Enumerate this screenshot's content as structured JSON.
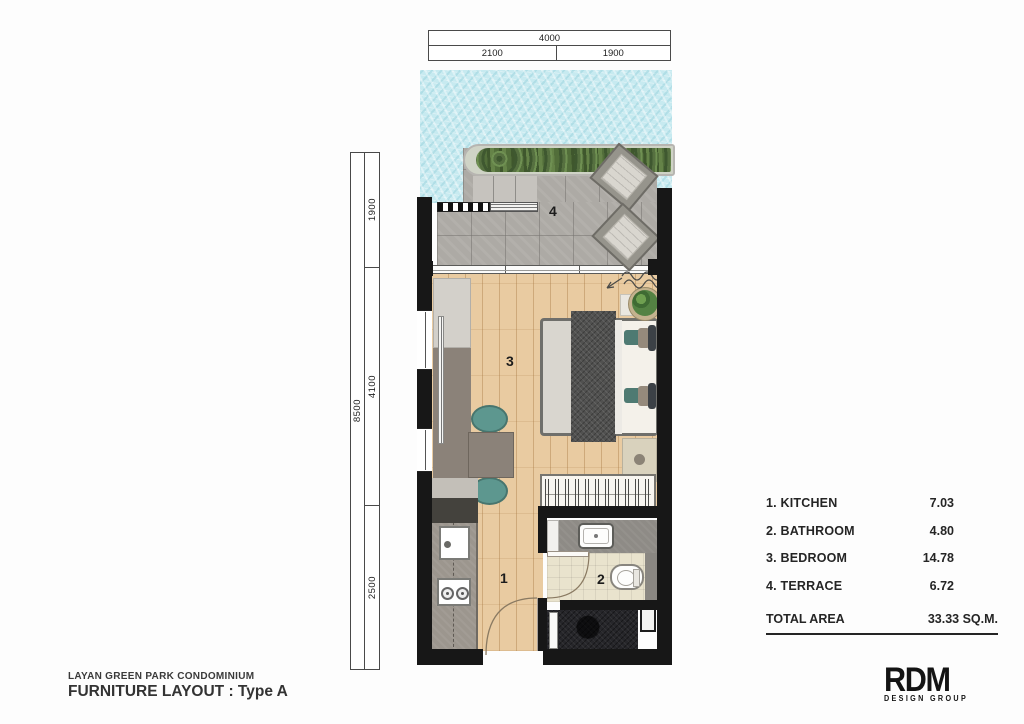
{
  "project": {
    "name": "LAYAN GREEN PARK CONDOMINIUM",
    "layout_title": "FURNITURE LAYOUT : Type A"
  },
  "logo": {
    "name": "RDM",
    "subtitle": "DESIGN GROUP"
  },
  "dimensions": {
    "top": {
      "total": "4000",
      "segments": [
        "2100",
        "1900"
      ]
    },
    "left": {
      "total": "8500",
      "segments": [
        "1900",
        "4100",
        "2500"
      ]
    }
  },
  "rooms": [
    {
      "num": "1",
      "name": "KITCHEN",
      "legend_label": "1. KITCHEN",
      "area": "7.03"
    },
    {
      "num": "2",
      "name": "BATHROOM",
      "legend_label": "2. BATHROOM",
      "area": "4.80"
    },
    {
      "num": "3",
      "name": "BEDROOM",
      "legend_label": "3. BEDROOM",
      "area": "14.78"
    },
    {
      "num": "4",
      "name": "TERRACE",
      "legend_label": "4. TERRACE",
      "area": "6.72"
    }
  ],
  "total": {
    "label": "TOTAL AREA",
    "value": "33.33 SQ.M."
  },
  "colors": {
    "wall": "#171717",
    "pool": "#c7eaf0",
    "terrace_tile": "#adaaa5",
    "wood_floor": "#e9cba1",
    "accent_teal": "#5d978f",
    "bathroom_floor": "#e9e3cd"
  }
}
